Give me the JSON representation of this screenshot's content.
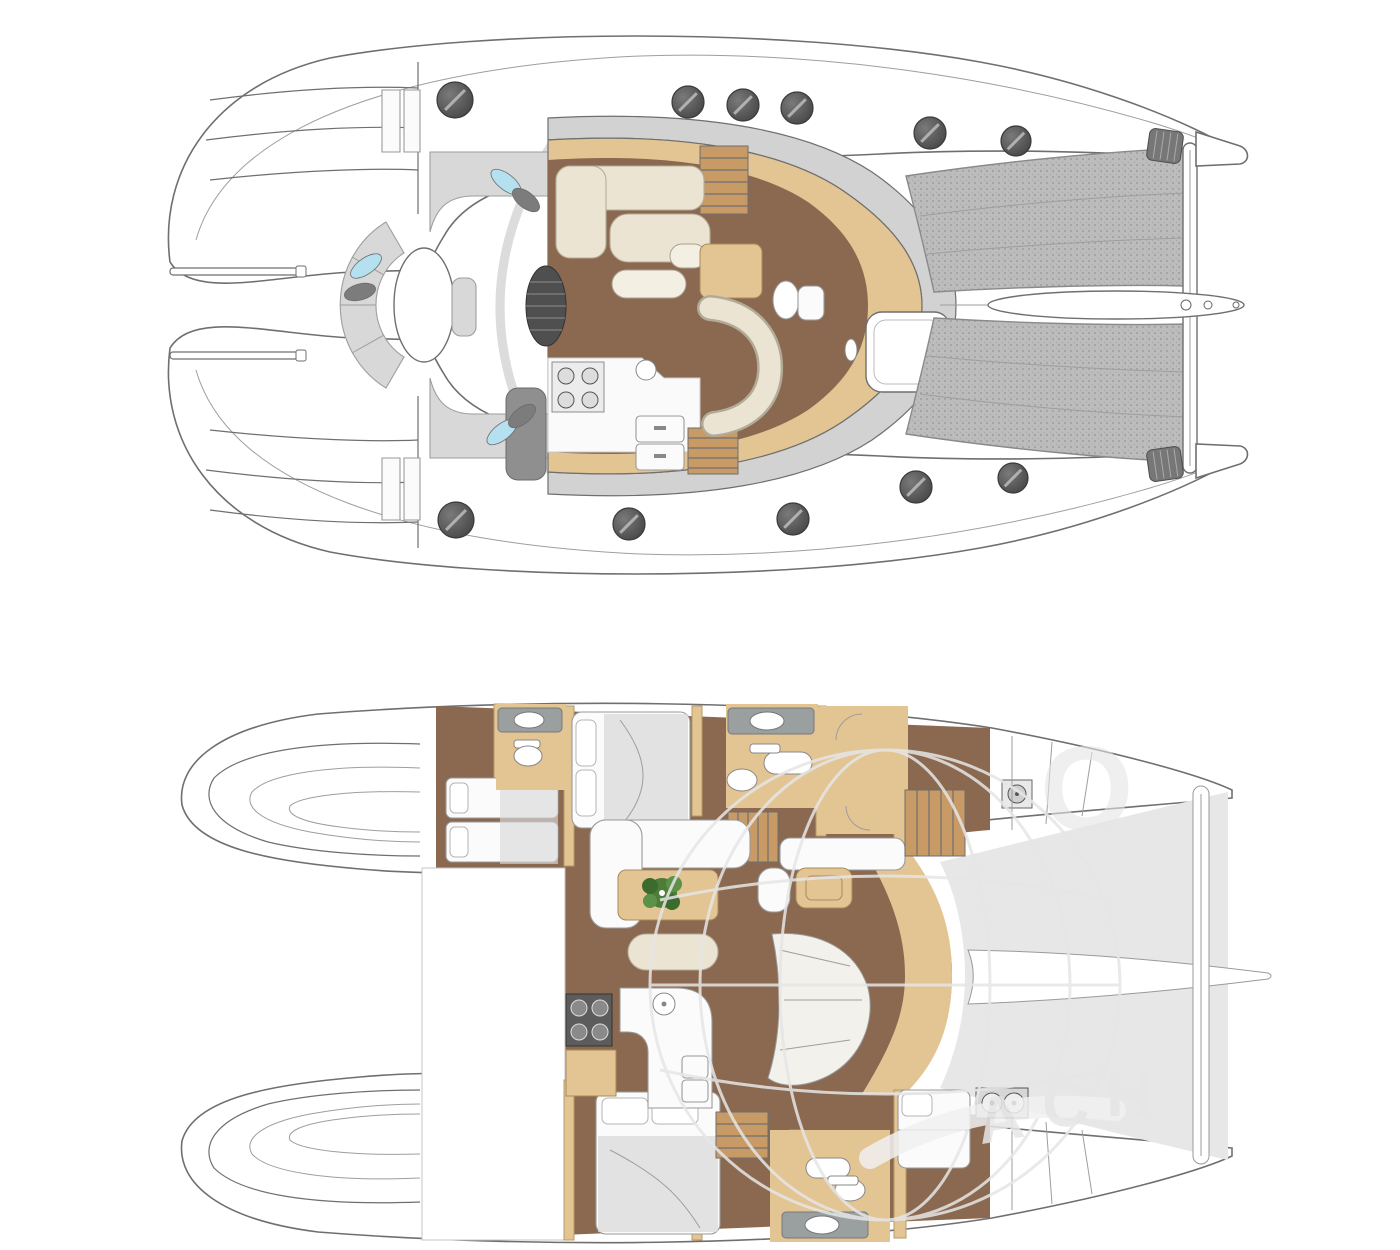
{
  "document": {
    "title": "Catamaran yacht layout plans (top: exterior deck plan, bottom: accommodation plan)",
    "watermark": {
      "arc_letters": [
        "A",
        "C",
        "H"
      ],
      "top_letter": "O"
    }
  },
  "colors": {
    "canvas_bg": "#ffffff",
    "line": "#6f6f6f",
    "line_light": "#9e9e9e",
    "deck_shadow": "#dcdcdc",
    "cushion_gray": "#d8d8d8",
    "cushion_dark": "#8f8f8f",
    "pillow_cyan": "#b5e0f0",
    "pillow_dark": "#7c7c7c",
    "wood_floor": "#8a6950",
    "wood_light": "#e3c493",
    "wood_step": "#c89a66",
    "cream": "#ece4d2",
    "white_furniture": "#fbfbfb",
    "counter_gray": "#9aa0a0",
    "trampoline": "#bcbcbc",
    "tramp_area": "#e7e7e7",
    "watermark": "#e6e6e6",
    "plant_green": "#4e7d3a",
    "bed_gray": "#d9d9d9",
    "hatch_dark": "#4e4e4e"
  },
  "upper_deck": {
    "name": "exterior-deck-plan",
    "hatches": [
      [
        455,
        100,
        18
      ],
      [
        688,
        102,
        16
      ],
      [
        743,
        105,
        16
      ],
      [
        797,
        108,
        16
      ],
      [
        930,
        133,
        16
      ],
      [
        1016,
        141,
        15
      ],
      [
        456,
        520,
        18
      ],
      [
        629,
        524,
        16
      ],
      [
        793,
        519,
        16
      ],
      [
        916,
        487,
        16
      ],
      [
        1013,
        478,
        15
      ]
    ],
    "pillows": [
      {
        "x": 366,
        "y": 266,
        "rot": -35,
        "color": "cyan"
      },
      {
        "x": 360,
        "y": 292,
        "rot": -15,
        "color": "dark"
      },
      {
        "x": 506,
        "y": 182,
        "rot": 38,
        "color": "cyan"
      },
      {
        "x": 526,
        "y": 200,
        "rot": 38,
        "color": "dark"
      },
      {
        "x": 502,
        "y": 432,
        "rot": -38,
        "color": "cyan"
      },
      {
        "x": 522,
        "y": 416,
        "rot": -38,
        "color": "dark"
      }
    ],
    "stern_rails_y": [
      268,
      352
    ],
    "features": [
      "stern-steps",
      "aft-cockpit",
      "round-table",
      "curved-bench",
      "corner-sofas",
      "saloon",
      "galley-up",
      "dinette",
      "foredeck-hatch",
      "trampolines",
      "bowsprit",
      "forward-crossbeam"
    ]
  },
  "lower_deck": {
    "name": "accommodation-plan",
    "features": [
      "twin-berth-cabin",
      "port-double-cabin",
      "port-bathrooms",
      "saloon-lounge",
      "plant-table",
      "galley-down",
      "nav-desk",
      "companionway-seat",
      "starboard-double-cabin",
      "starboard-bathroom",
      "forward-berth",
      "washer-units",
      "nacelle",
      "trampoline-area"
    ]
  }
}
